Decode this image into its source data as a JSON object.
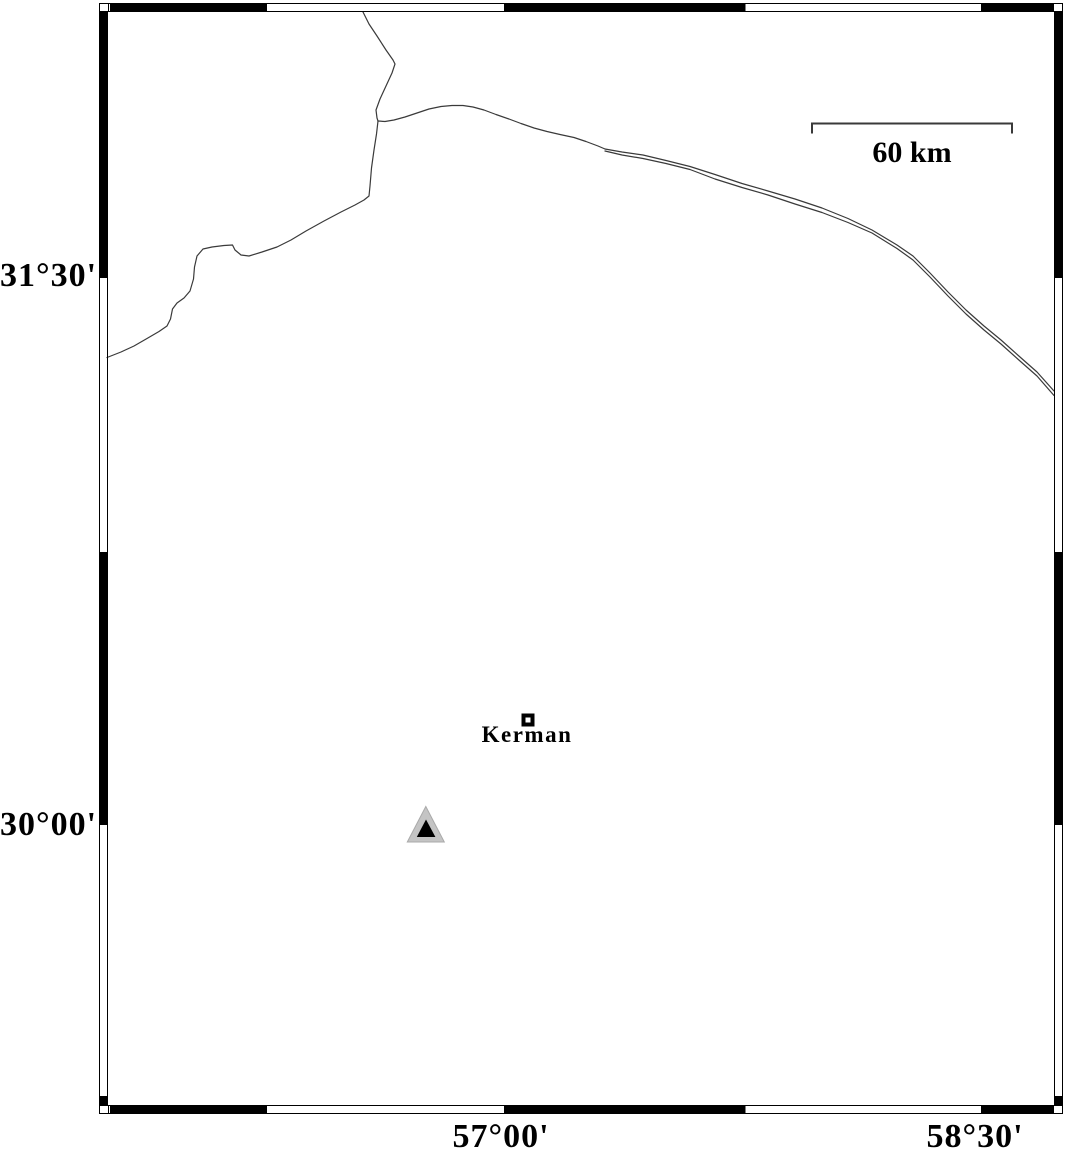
{
  "figure": {
    "type": "geographic-map",
    "region": "Kerman area, Iran"
  },
  "labels": {
    "lat_top": "31°30'",
    "lat_bottom": "30°00'",
    "lon_left": "57°00'",
    "lon_right": "58°30'"
  },
  "scale_bar": {
    "label": "60 km",
    "points": "812,133.5 812,123.5 1012,123.5 1012,133.5"
  },
  "city": {
    "name": "Kerman"
  },
  "markers": {
    "triangle_outer_points": "425.8,806.5 407.3,842 444.3,842",
    "triangle_inner_points": "426,819.5 416.8,837 435.4,837"
  },
  "map_lines": {
    "north_stub": "363,12 369,24 377,36 386,50 393,60 395,64 392,73 386,86 380,99 376,110 377,118 378,121",
    "mid_coast": "378,121 385,121.5 394,120 405,117 417,113 429,109 441,106.5 452,105.5 463,105.5 473,107 484,110 496,114.5 509,119 521,123.5 534,128 547,131.5 560,134.5 574,137.5 586,141.5 598,146 605,149",
    "east_upper": "605,149 622,152 643,155 666,160.5 690,166.5 715,174.5 742,183.5 768,191 795,199 822,208 848,218.5 872,230 897,245 913,256 930,273 948,292 966,310 984,326 1001,340 1020,357 1037,372 1054,391",
    "east_lower": "605,151 622,155 643,158.5 666,163.5 690,169.5 715,179 742,187.5 768,195 795,204 822,212.5 848,222.5 872,233 897,248.5 913,260 930,277 948,296 966,314 984,330 1001,344 1020,361 1037,376 1054,395.5",
    "southwest": "378,121 376.5,134 374,150 371.5,168 370,186 369,196 364,200 355,205 341,212 324,221 306,231 291,240 277,247 262,252 249,256 241,255 235,250 232.5,245 224,245.5 212,247 203,249 197,256 194.5,267 193.5,279 190,291 184,298 177,303 172.5,309 170.5,319 167,326 159,331.5 147,338.5 134,346 121,352 107,357.5"
  },
  "colors": {
    "background": "#ffffff",
    "frame": "#000000",
    "map_line": "#3a3a3a",
    "triangle_fill": "#c4c4c4",
    "triangle_core": "#000000",
    "text": "#000000"
  }
}
